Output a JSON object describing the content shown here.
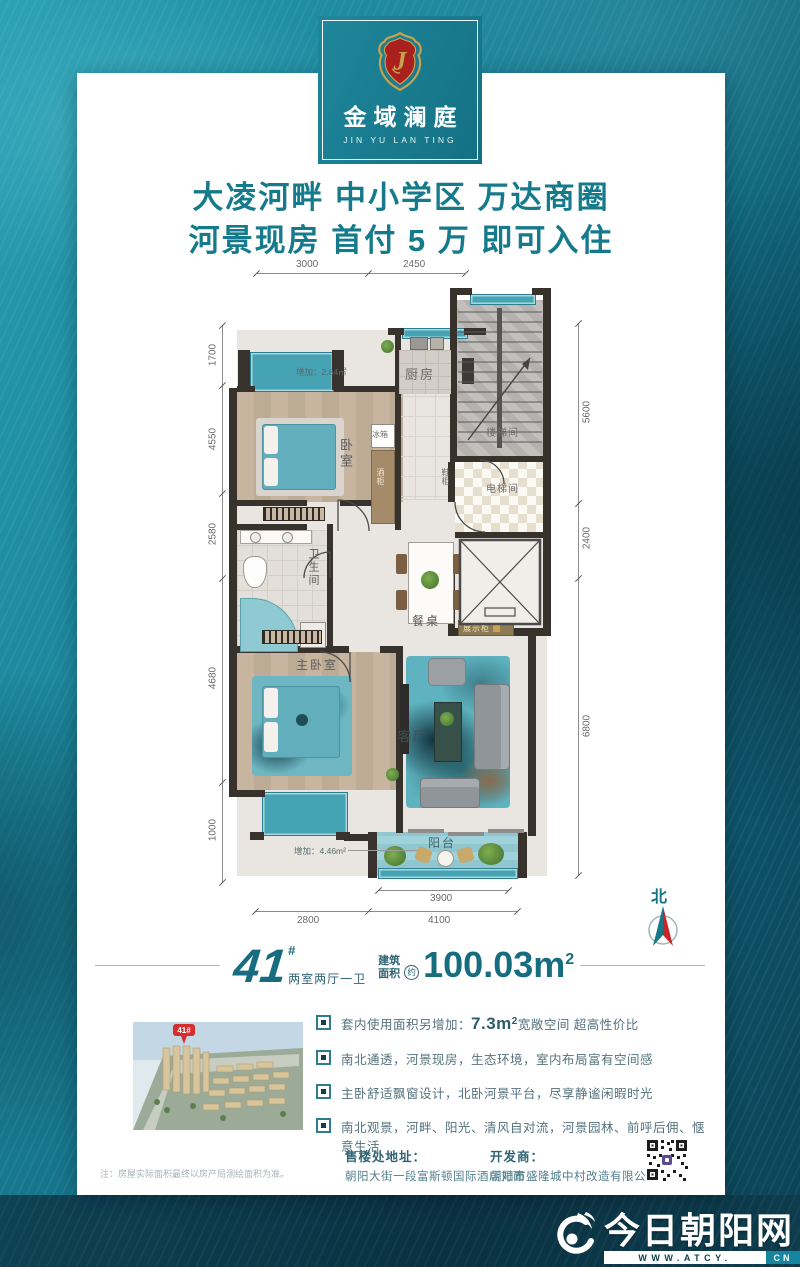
{
  "brand": {
    "name_cn": "金域澜庭",
    "name_en": "JIN YU LAN TING"
  },
  "headline": {
    "line1": "大凌河畔  中小学区  万达商圈",
    "line2": "河景现房  首付 5 万  即可入住"
  },
  "plan": {
    "labels": {
      "bedroom": "卧室",
      "kitchen": "厨房",
      "stairwell": "楼梯间",
      "elevator_hall": "电梯间",
      "bathroom": "卫生间",
      "master_bedroom": "主卧室",
      "living_room": "客厅",
      "balcony": "阳台",
      "dining_table": "餐桌",
      "display_cabinet": "展示柜",
      "fridge": "冰箱",
      "wine_cabinet": "酒柜",
      "shoe_cabinet": "鞋柜"
    },
    "annotations": {
      "north_bay": "增加：2.84㎡",
      "south_bay": "增加：4.46m²"
    },
    "dims": {
      "top": [
        "3000",
        "2450"
      ],
      "left": [
        "1700",
        "4550",
        "2580",
        "4680",
        "1000"
      ],
      "right": [
        "5600",
        "2400",
        "6800"
      ],
      "balcony": "3900",
      "bottom": [
        "2800",
        "4100"
      ]
    },
    "compass": {
      "label": "北"
    }
  },
  "unit": {
    "number": "41",
    "hash": "#",
    "layout": "两室两厅一卫",
    "area_label_top": "建筑",
    "area_label_bottom": "面积",
    "approx": "约",
    "area_value": "100.03m",
    "area_sup": "2"
  },
  "features": {
    "f1_pre": "套内使用面积另增加：",
    "f1_value": "7.3m",
    "f1_sup": "2",
    "f1_post": "宽敞空间 超高性价比",
    "f2": "南北通透，河景现房，生态环境，室内布局富有空间感",
    "f3": "主卧舒适飘窗设计，北卧河景平台，尽享静谧闲暇时光",
    "f4": "南北观景，河畔、阳光、清风自对流，河景园林、前呼后佣、惬意生活"
  },
  "thumbnail": {
    "pin_label": "41#"
  },
  "contact": {
    "address_label": "售楼处地址：",
    "address": "朝阳大街一段富斯顿国际酒店对面",
    "developer_label": "开发商：",
    "developer": "朝阳市盛隆城中村改造有限公司"
  },
  "note": "注：房屋实际面积最终以房产局测绘面积为准。",
  "footer": {
    "site_name": "今日朝阳网",
    "url_main": "WWW.ATCY.",
    "url_suffix": "CN"
  },
  "colors": {
    "accent_teal": "#157a8c",
    "dark_teal": "#0e3d4d",
    "brand_red": "#a9201f",
    "gold": "#c9a24e",
    "compass_red": "#c62828"
  }
}
